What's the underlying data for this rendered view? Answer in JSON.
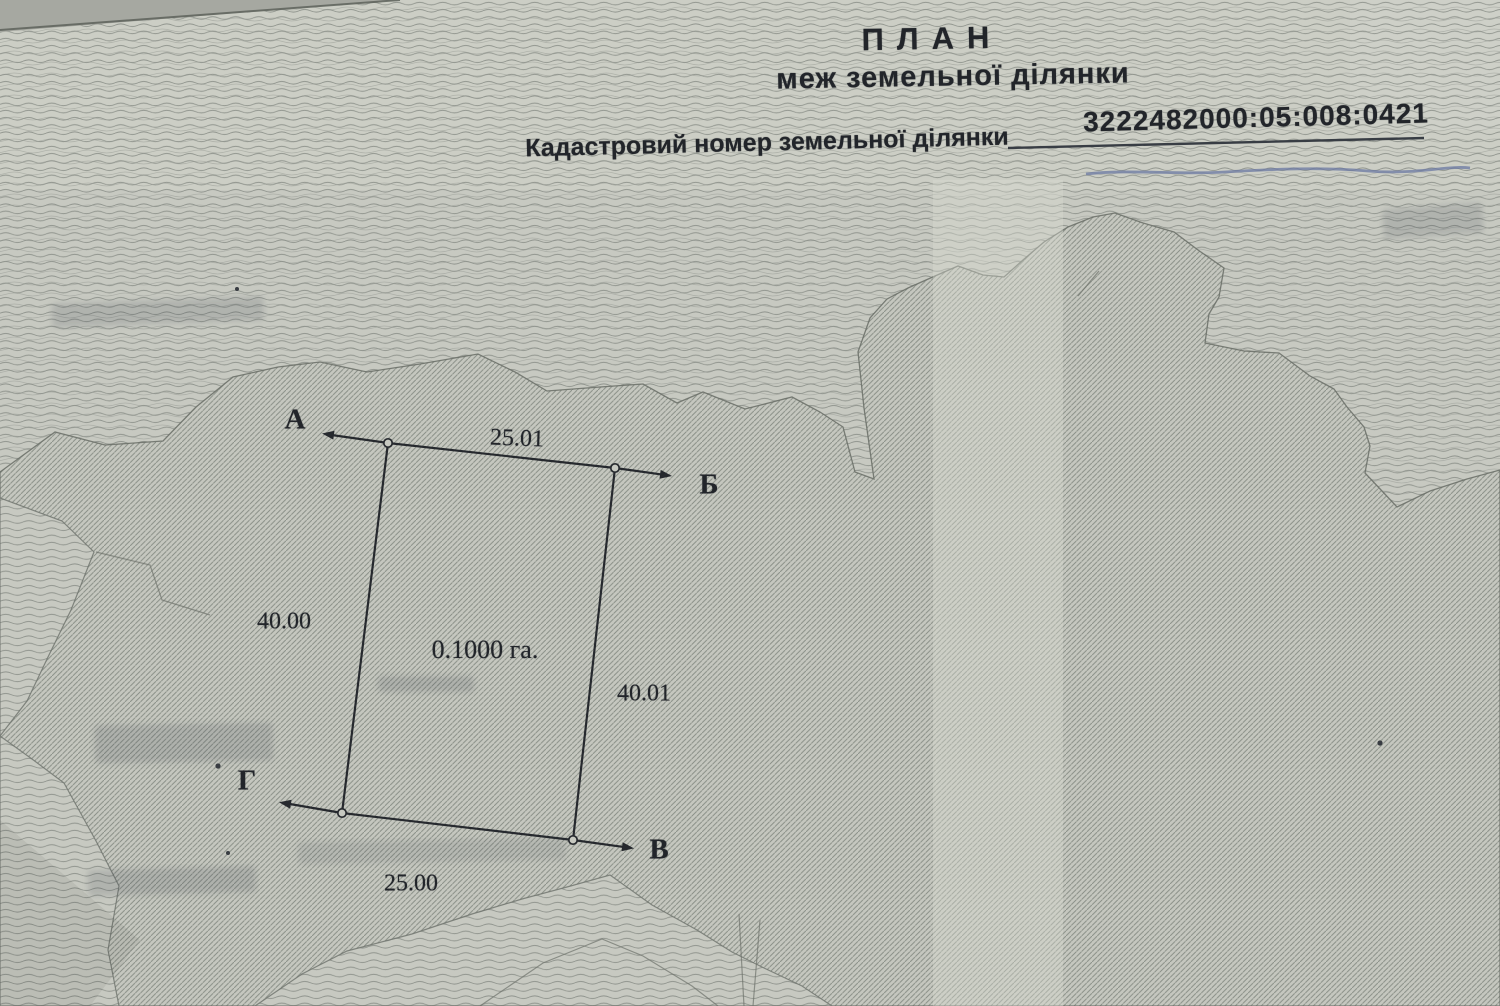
{
  "document": {
    "title": "ПЛАН",
    "subtitle": "меж земельної ділянки",
    "cadastral_label": "Кадастровий номер земельної ділянки",
    "cadastral_number": "3222482000:05:008:0421"
  },
  "plan": {
    "area_label": "0.1000 га.",
    "points": {
      "a": "А",
      "b": "Б",
      "v": "В",
      "g": "Г"
    },
    "lengths": {
      "top": "25.01",
      "left": "40.00",
      "right": "40.01",
      "bottom": "25.00"
    }
  }
}
